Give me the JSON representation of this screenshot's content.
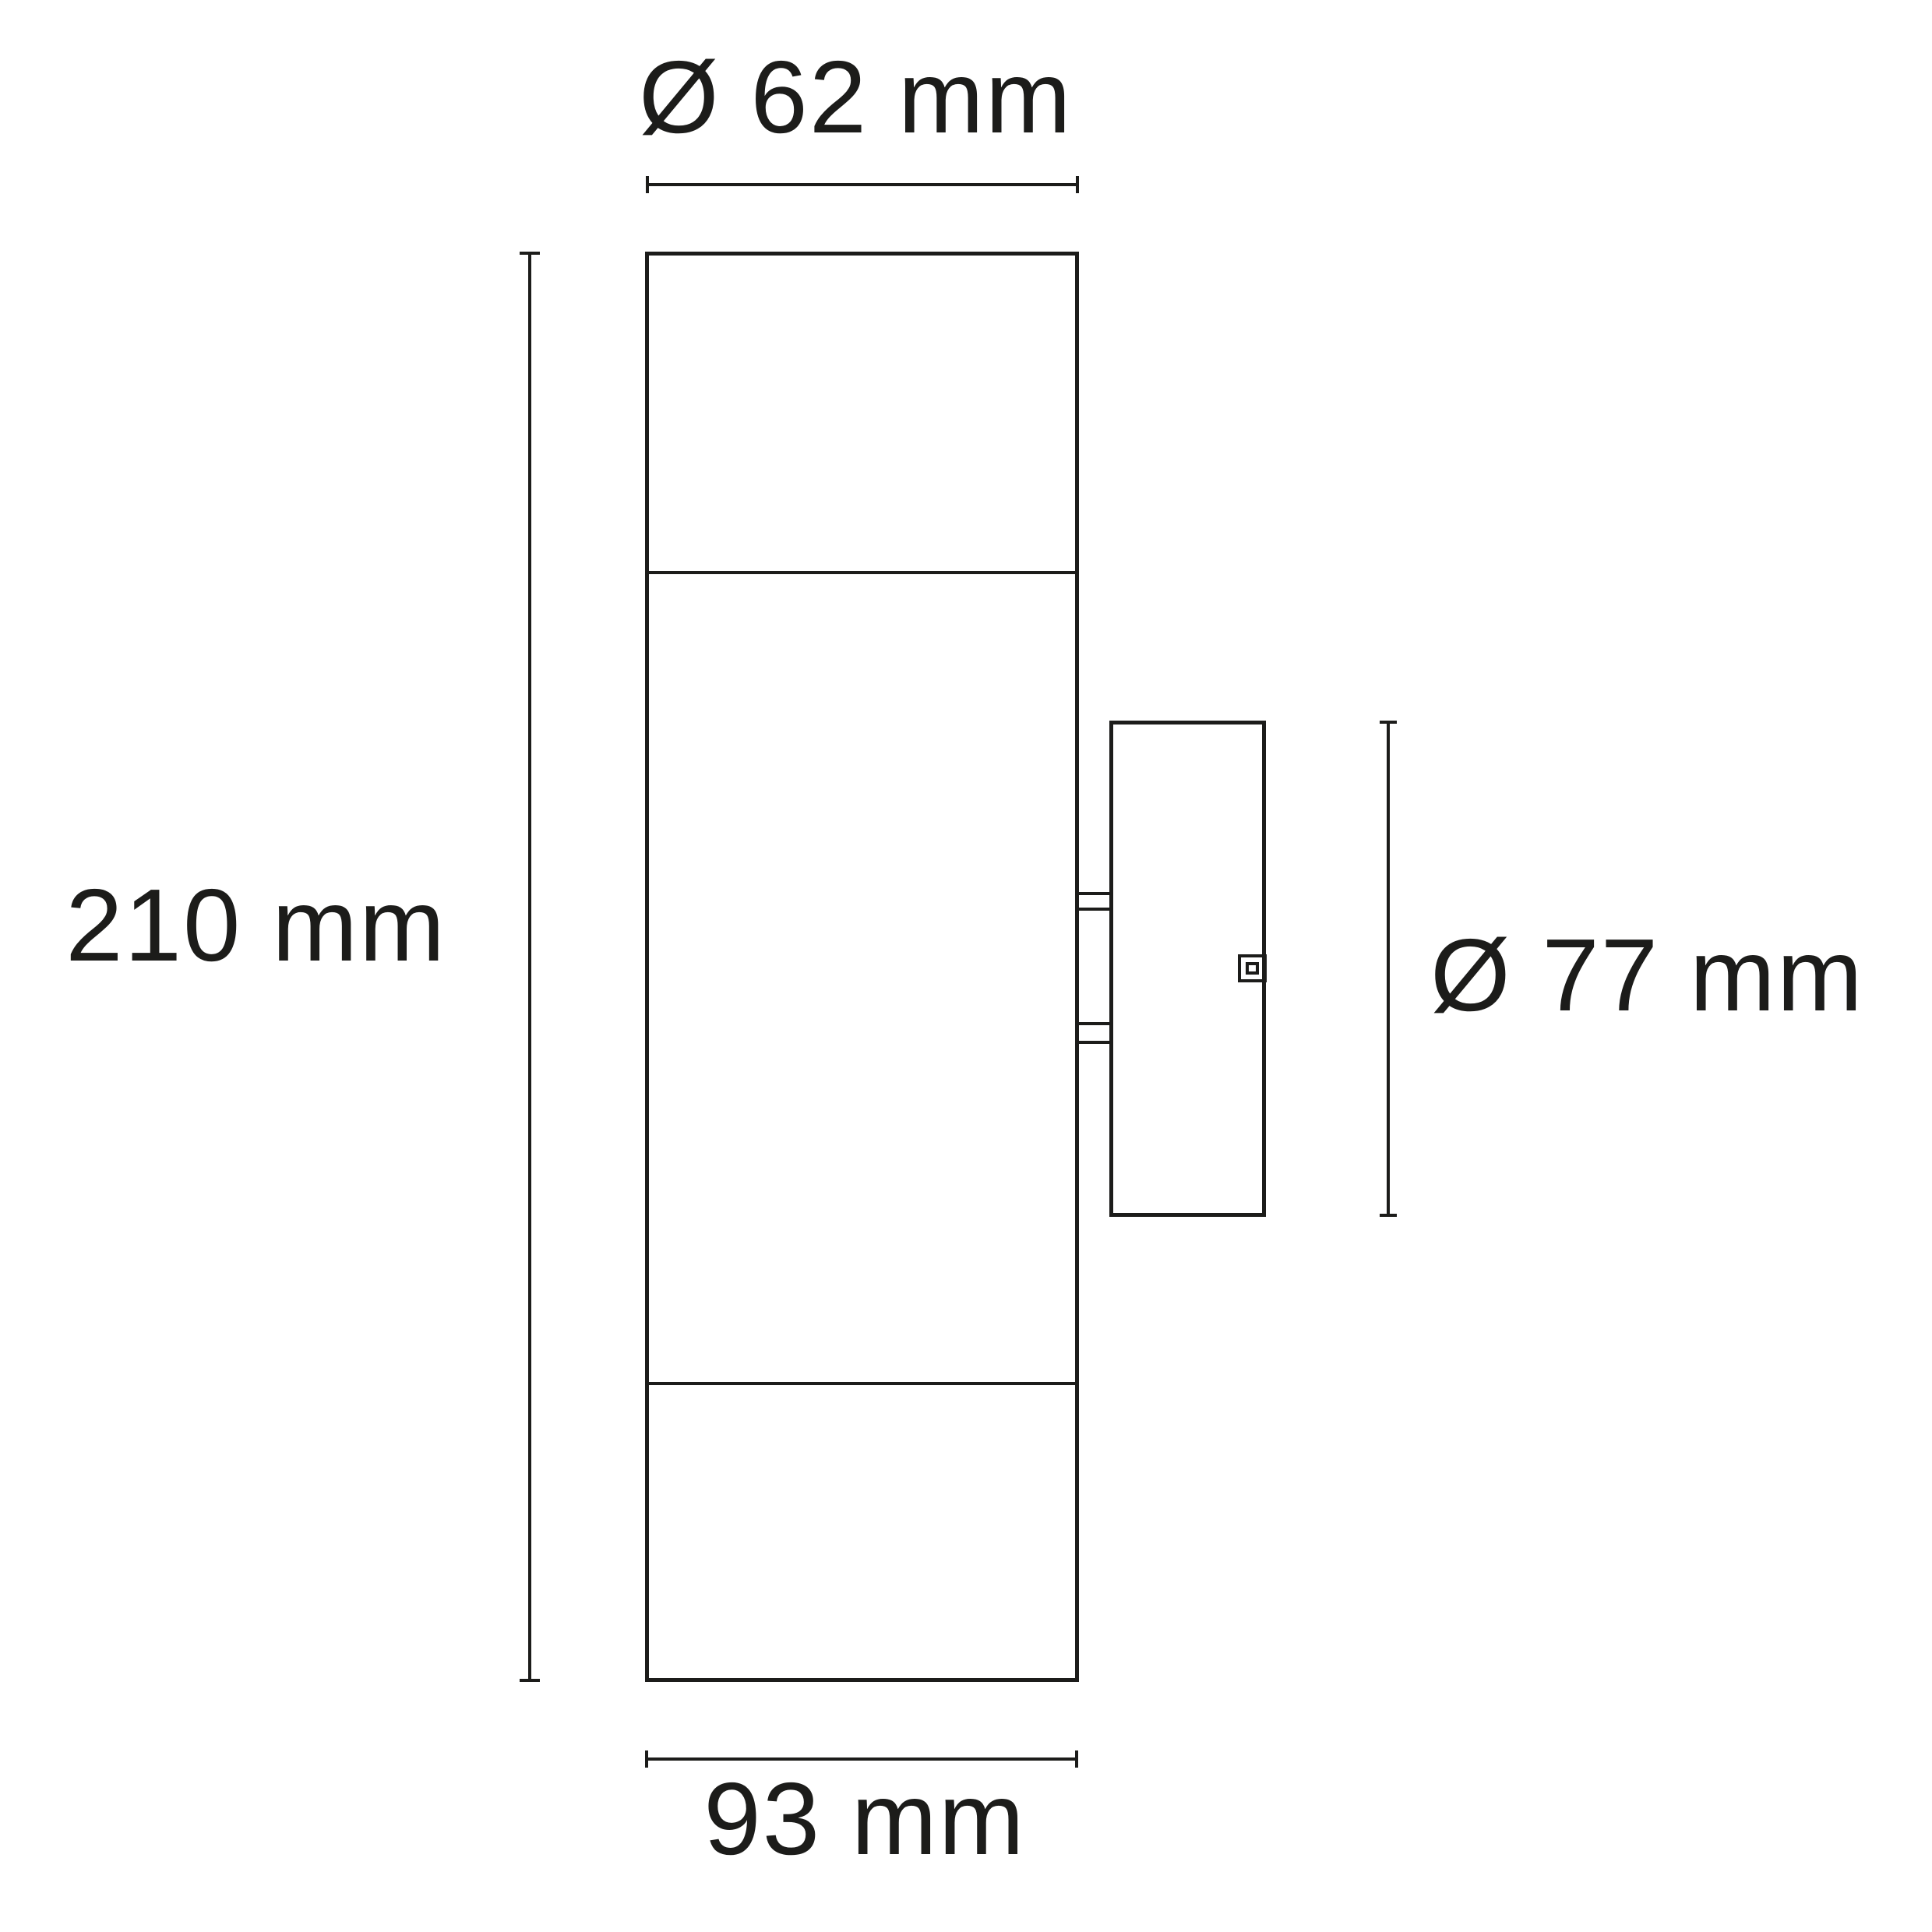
{
  "page": {
    "background_color": "#ffffff",
    "line_color": "#1c1c1a"
  },
  "drawing": {
    "kind": "technical-dimension-diagram",
    "subject": "cylindrical wall light with mounting backplate, side view",
    "dimensions": {
      "top_diameter": "Ø 62 mm",
      "height": "210 mm",
      "backplate_diameter": "Ø 77 mm",
      "depth": "93 mm"
    }
  }
}
